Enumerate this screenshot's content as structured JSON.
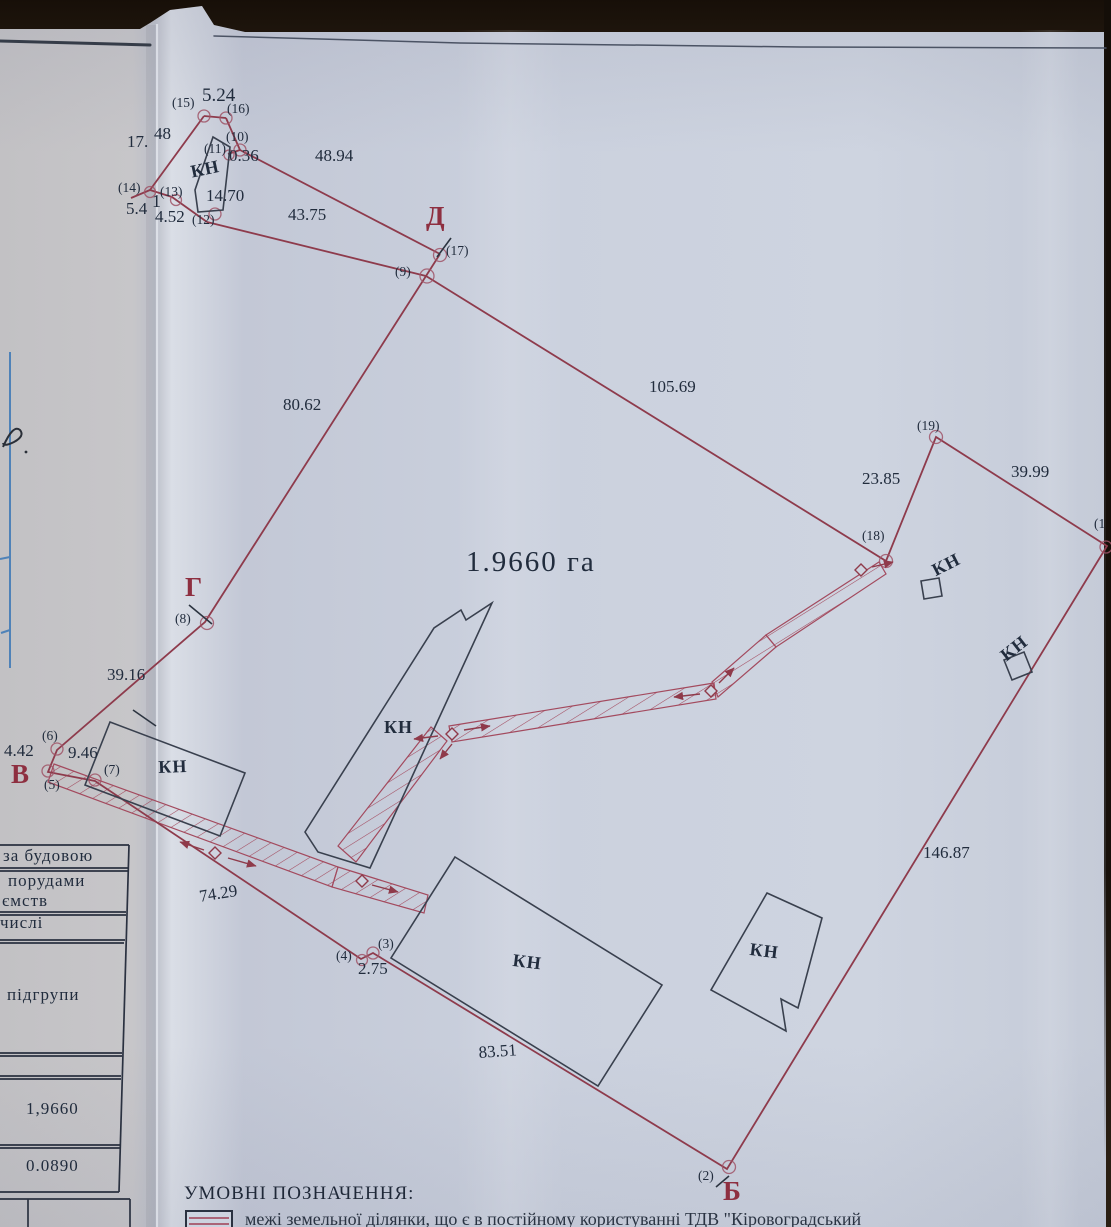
{
  "plan": {
    "area_label": "1.9660 га",
    "measurements": [
      {
        "t": "5.24",
        "x": 202,
        "y": 86,
        "s": 19
      },
      {
        "t": "17.",
        "x": 127,
        "y": 133
      },
      {
        "t": "48",
        "x": 154,
        "y": 125
      },
      {
        "t": "0.36",
        "x": 229,
        "y": 147
      },
      {
        "t": "48.94",
        "x": 315,
        "y": 147
      },
      {
        "t": "14.70",
        "x": 206,
        "y": 187
      },
      {
        "t": "4.52",
        "x": 155,
        "y": 208
      },
      {
        "t": "5.4",
        "x": 126,
        "y": 200
      },
      {
        "t": "1",
        "x": 152,
        "y": 192,
        "s": 18
      },
      {
        "t": "43.75",
        "x": 288,
        "y": 206
      },
      {
        "t": "80.62",
        "x": 283,
        "y": 396
      },
      {
        "t": "105.69",
        "x": 649,
        "y": 378
      },
      {
        "t": "23.85",
        "x": 862,
        "y": 470
      },
      {
        "t": "39.99",
        "x": 1011,
        "y": 463
      },
      {
        "t": "39.16",
        "x": 107,
        "y": 666
      },
      {
        "t": "4.42",
        "x": 4,
        "y": 742
      },
      {
        "t": "9.46",
        "x": 68,
        "y": 744
      },
      {
        "t": "74.29",
        "x": 198,
        "y": 888,
        "r": -9
      },
      {
        "t": "2.75",
        "x": 358,
        "y": 960
      },
      {
        "t": "83.51",
        "x": 478,
        "y": 1044,
        "r": -4
      },
      {
        "t": "146.87",
        "x": 923,
        "y": 844
      }
    ],
    "points": [
      {
        "t": "(15)",
        "x": 172,
        "y": 96
      },
      {
        "t": "(16)",
        "x": 227,
        "y": 102
      },
      {
        "t": "(10)",
        "x": 226,
        "y": 130
      },
      {
        "t": "(11)",
        "x": 204,
        "y": 142
      },
      {
        "t": "(14)",
        "x": 118,
        "y": 181
      },
      {
        "t": "(13)",
        "x": 160,
        "y": 185
      },
      {
        "t": "(12)",
        "x": 192,
        "y": 213
      },
      {
        "t": "(9)",
        "x": 395,
        "y": 265
      },
      {
        "t": "(17)",
        "x": 446,
        "y": 244
      },
      {
        "t": "(19)",
        "x": 917,
        "y": 419
      },
      {
        "t": "(18)",
        "x": 862,
        "y": 529
      },
      {
        "t": "(1",
        "x": 1094,
        "y": 517
      },
      {
        "t": "(8)",
        "x": 175,
        "y": 612
      },
      {
        "t": "(6)",
        "x": 42,
        "y": 729
      },
      {
        "t": "(5)",
        "x": 44,
        "y": 778
      },
      {
        "t": "(7)",
        "x": 104,
        "y": 763
      },
      {
        "t": "(4)",
        "x": 336,
        "y": 949
      },
      {
        "t": "(3)",
        "x": 378,
        "y": 937
      },
      {
        "t": "(2)",
        "x": 698,
        "y": 1169
      }
    ],
    "kn_labels": [
      {
        "t": "КН",
        "x": 189,
        "y": 163,
        "r": -12
      },
      {
        "t": "КН",
        "x": 158,
        "y": 758,
        "r": -2
      },
      {
        "t": "КН",
        "x": 384,
        "y": 718
      },
      {
        "t": "КН",
        "x": 514,
        "y": 951,
        "r": 7
      },
      {
        "t": "КН",
        "x": 751,
        "y": 940,
        "r": 7
      },
      {
        "t": "КН",
        "x": 929,
        "y": 563,
        "r": -27
      },
      {
        "t": "КН",
        "x": 997,
        "y": 650,
        "r": -38
      }
    ],
    "corner_letters": [
      {
        "t": "Д",
        "x": 426,
        "y": 203
      },
      {
        "t": "Г",
        "x": 185,
        "y": 574
      },
      {
        "t": "В",
        "x": 11,
        "y": 761
      },
      {
        "t": "Б",
        "x": 723,
        "y": 1178
      }
    ]
  },
  "table": {
    "rows": [
      {
        "t": "за будовою",
        "x": 3,
        "y": 847
      },
      {
        "t": "порудами",
        "x": 8,
        "y": 872
      },
      {
        "t": "ємств",
        "x": 2,
        "y": 892
      },
      {
        "t": "числі",
        "x": 0,
        "y": 914
      },
      {
        "t": "підгрупи",
        "x": 7,
        "y": 986
      },
      {
        "t": "1,9660",
        "x": 26,
        "y": 1100
      },
      {
        "t": "0.0890",
        "x": 26,
        "y": 1157
      }
    ]
  },
  "legend": {
    "title": "УМОВНІ ПОЗНАЧЕННЯ:",
    "item": "межі земельної ділянки, що є в постійному користуванні ТДВ \"Кіровоградський"
  }
}
